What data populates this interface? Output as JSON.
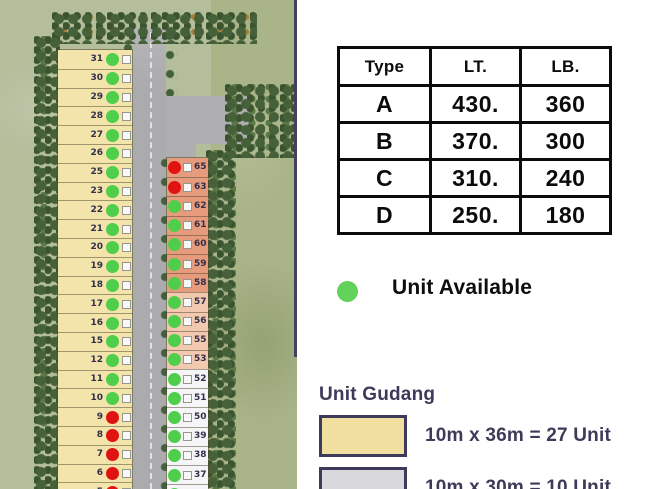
{
  "table": {
    "headers": [
      "Type",
      "LT.",
      "LB."
    ],
    "rows": [
      [
        "A",
        "430.",
        "360"
      ],
      [
        "B",
        "370.",
        "300"
      ],
      [
        "C",
        "310.",
        "240"
      ],
      [
        "D",
        "250.",
        "180"
      ]
    ]
  },
  "availability_legend": {
    "label": "Unit Available"
  },
  "unit_gudang": {
    "title": "Unit Gudang",
    "items": [
      {
        "swatch": "yellow",
        "label": "10m x 36m = 27 Unit"
      },
      {
        "swatch": "grey",
        "label": "10m x 30m = 10 Unit"
      }
    ]
  },
  "site_plan": {
    "left_column": {
      "units": [
        {
          "no": "31",
          "status": "available",
          "group": "yellow"
        },
        {
          "no": "30",
          "status": "available",
          "group": "yellow"
        },
        {
          "no": "29",
          "status": "available",
          "group": "yellow"
        },
        {
          "no": "28",
          "status": "available",
          "group": "yellow"
        },
        {
          "no": "27",
          "status": "available",
          "group": "yellow"
        },
        {
          "no": "26",
          "status": "available",
          "group": "yellow"
        },
        {
          "no": "25",
          "status": "available",
          "group": "yellow"
        },
        {
          "no": "23",
          "status": "available",
          "group": "yellow"
        },
        {
          "no": "22",
          "status": "available",
          "group": "yellow"
        },
        {
          "no": "21",
          "status": "available",
          "group": "yellow"
        },
        {
          "no": "20",
          "status": "available",
          "group": "yellow"
        },
        {
          "no": "19",
          "status": "available",
          "group": "yellow"
        },
        {
          "no": "18",
          "status": "available",
          "group": "yellow"
        },
        {
          "no": "17",
          "status": "available",
          "group": "yellow"
        },
        {
          "no": "16",
          "status": "available",
          "group": "yellow"
        },
        {
          "no": "15",
          "status": "available",
          "group": "yellow"
        },
        {
          "no": "12",
          "status": "available",
          "group": "yellow"
        },
        {
          "no": "11",
          "status": "available",
          "group": "yellow"
        },
        {
          "no": "10",
          "status": "available",
          "group": "yellow"
        },
        {
          "no": "9",
          "status": "sold",
          "group": "yellow"
        },
        {
          "no": "8",
          "status": "sold",
          "group": "yellow"
        },
        {
          "no": "7",
          "status": "sold",
          "group": "yellow"
        },
        {
          "no": "6",
          "status": "sold",
          "group": "yellow"
        },
        {
          "no": "5",
          "status": "sold",
          "group": "yellow"
        }
      ]
    },
    "middle_column": {
      "units": [
        {
          "no": "65",
          "status": "sold",
          "group": "salmon"
        },
        {
          "no": "63",
          "status": "sold",
          "group": "salmon"
        },
        {
          "no": "62",
          "status": "available",
          "group": "salmon"
        },
        {
          "no": "61",
          "status": "available",
          "group": "salmon"
        },
        {
          "no": "60",
          "status": "available",
          "group": "salmon"
        },
        {
          "no": "59",
          "status": "available",
          "group": "salmon"
        },
        {
          "no": "58",
          "status": "available",
          "group": "salmon"
        },
        {
          "no": "57",
          "status": "available",
          "group": "peach"
        },
        {
          "no": "56",
          "status": "available",
          "group": "peach"
        },
        {
          "no": "55",
          "status": "available",
          "group": "peach"
        },
        {
          "no": "53",
          "status": "available",
          "group": "peach"
        },
        {
          "no": "52",
          "status": "available",
          "group": "white"
        },
        {
          "no": "51",
          "status": "available",
          "group": "white"
        },
        {
          "no": "50",
          "status": "available",
          "group": "white"
        },
        {
          "no": "39",
          "status": "available",
          "group": "white"
        },
        {
          "no": "38",
          "status": "available",
          "group": "white"
        },
        {
          "no": "37",
          "status": "available",
          "group": "white"
        },
        {
          "no": "",
          "status": "available",
          "group": "white"
        }
      ]
    }
  },
  "colors": {
    "available_green": "#4FCE4B",
    "sold_red": "#E11212",
    "unit_yellow": "#F2E4AB",
    "unit_salmon": "#E69B7C",
    "unit_peach": "#F2C9AE",
    "unit_white": "#F5F4F6",
    "legend_yellow": "#F0DF9F",
    "legend_grey": "#D9D9DD",
    "navy": "#3E3A59"
  }
}
